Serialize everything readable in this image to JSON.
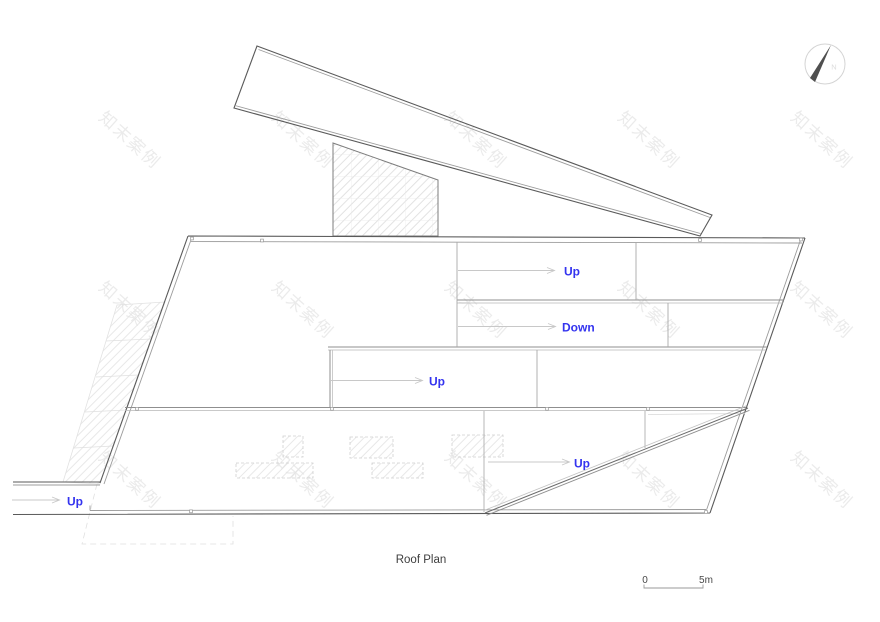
{
  "colors": {
    "label_blue": "#3434ef"
  },
  "watermark": {
    "text": "知末案例"
  },
  "drawing": {
    "title": "Roof Plan",
    "labels": {
      "upper_up": "Up",
      "down": "Down",
      "middle_up": "Up",
      "lower_up": "Up",
      "entry_up": "Up"
    },
    "north": {
      "label": "N"
    },
    "scale_bar": {
      "zero": "0",
      "five": "5m"
    }
  }
}
